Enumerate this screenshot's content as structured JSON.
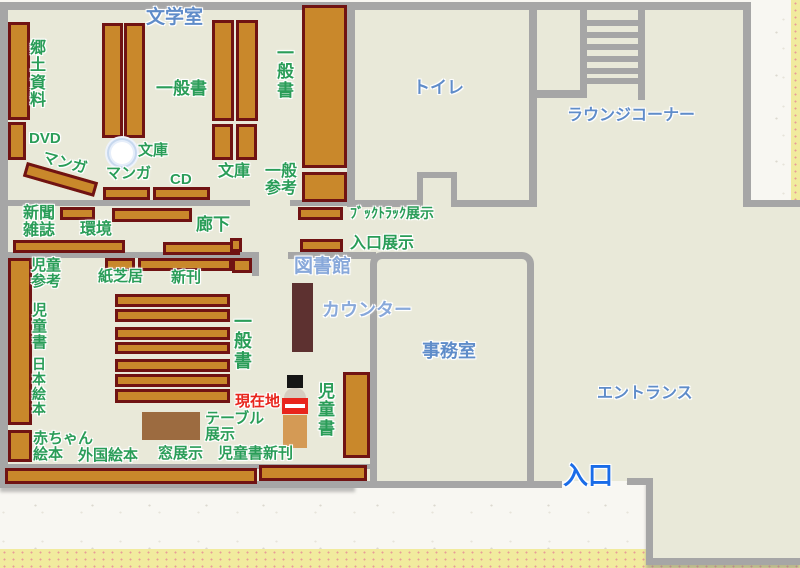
{
  "rooms": [
    {
      "id": "literature-room",
      "text": "文学室"
    },
    {
      "id": "toilet",
      "text": "トイレ"
    },
    {
      "id": "lounge-corner",
      "text": "ラウンジコーナー"
    },
    {
      "id": "library",
      "text": "図書館"
    },
    {
      "id": "counter",
      "text": "カウンター"
    },
    {
      "id": "office",
      "text": "事務室"
    },
    {
      "id": "entrance-hall",
      "text": "エントランス"
    },
    {
      "id": "entrance-door",
      "text": "入口"
    }
  ],
  "marker": {
    "current_location": "現在地"
  },
  "shelves": [
    {
      "id": "local-materials",
      "text": "郷土資料"
    },
    {
      "id": "dvd",
      "text": "DVD"
    },
    {
      "id": "manga-diagonal",
      "text": "マンガ"
    },
    {
      "id": "manga",
      "text": "マンガ"
    },
    {
      "id": "cd",
      "text": "CD"
    },
    {
      "id": "bunko-pillar",
      "text": "文庫"
    },
    {
      "id": "bunko",
      "text": "文庫"
    },
    {
      "id": "general-books-1",
      "text": "一般書"
    },
    {
      "id": "general-books-2",
      "text": "一般書"
    },
    {
      "id": "general-reference",
      "text": "一般参考"
    },
    {
      "id": "newspapers-magazines",
      "text": "新聞雑誌"
    },
    {
      "id": "environment",
      "text": "環境"
    },
    {
      "id": "corridor",
      "text": "廊下"
    },
    {
      "id": "kamishibai",
      "text": "紙芝居"
    },
    {
      "id": "new-arrivals",
      "text": "新刊"
    },
    {
      "id": "children-reference",
      "text": "児童参考"
    },
    {
      "id": "children-books-left",
      "text": "児童書"
    },
    {
      "id": "japanese-picture-books",
      "text": "日本絵本"
    },
    {
      "id": "baby-picture-books",
      "text": "赤ちゃん絵本"
    },
    {
      "id": "foreign-picture-books",
      "text": "外国絵本"
    },
    {
      "id": "window-display",
      "text": "窓展示"
    },
    {
      "id": "children-new-arrivals",
      "text": "児童書新刊"
    },
    {
      "id": "table-display",
      "text": "テーブル展示"
    },
    {
      "id": "children-books-right",
      "text": "児童書"
    },
    {
      "id": "general-books-children-area",
      "text": "一般書"
    },
    {
      "id": "booktruck-display",
      "text": "ﾌﾞｯｸﾄﾗｯｸ展示"
    },
    {
      "id": "entrance-display",
      "text": "入口展示"
    }
  ],
  "colors": {
    "floor": "#e9e9d9",
    "wall": "#a6a6a6",
    "shelf_fill": "#c9882b",
    "shelf_border": "#701313",
    "counter": "#5d3130",
    "table": "#9c6b40",
    "label_green": "#2a9d58",
    "label_blue": "#5f8cc9",
    "label_blue_light": "#88a8da",
    "entrance_blue": "#1a6ce8",
    "current_location_red": "#e8251c",
    "paper": "#f8f7f2",
    "paper_edge": "#f1eb9e"
  }
}
